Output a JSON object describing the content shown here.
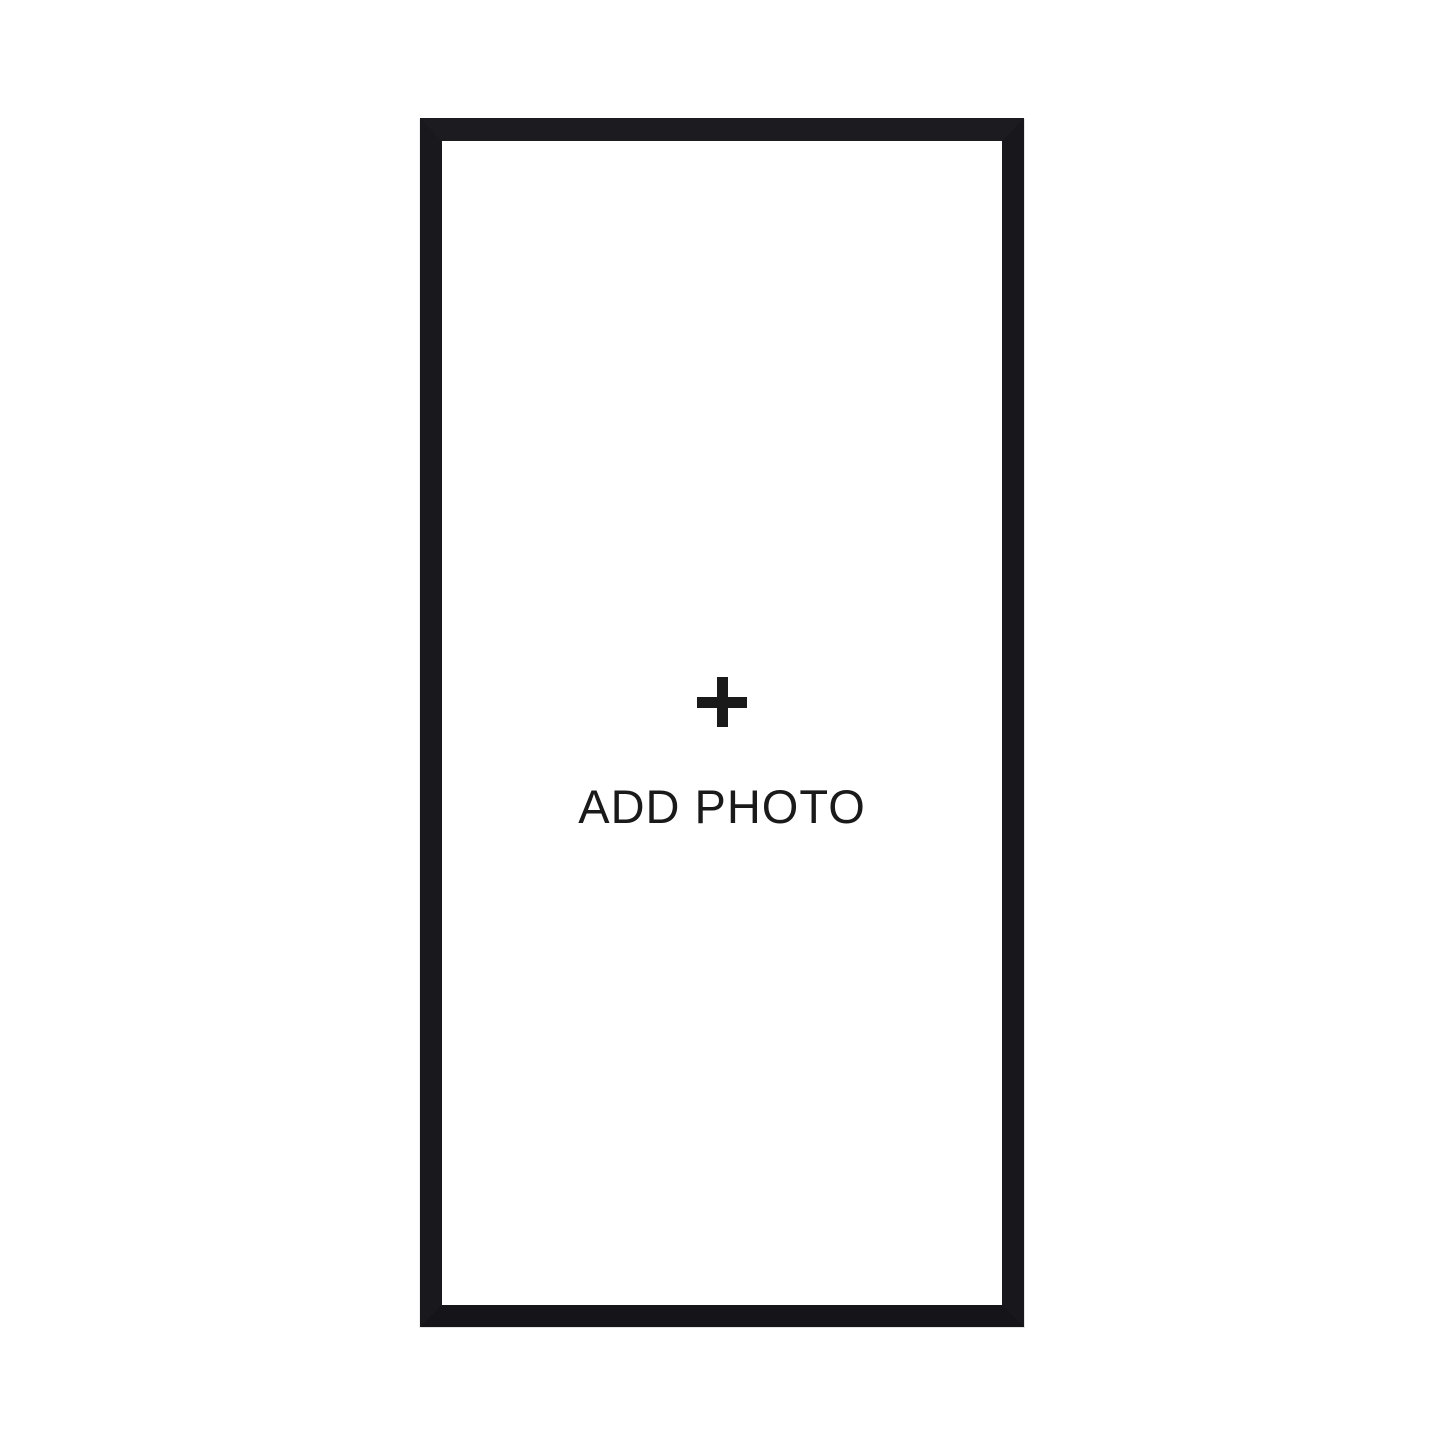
{
  "page": {
    "background_color": "#ffffff"
  },
  "frame": {
    "color": "#1a1a1c",
    "inner_color": "#ffffff"
  },
  "add_photo": {
    "icon": "plus-icon",
    "label": "ADD PHOTO",
    "text_color": "#1a1a1a"
  }
}
